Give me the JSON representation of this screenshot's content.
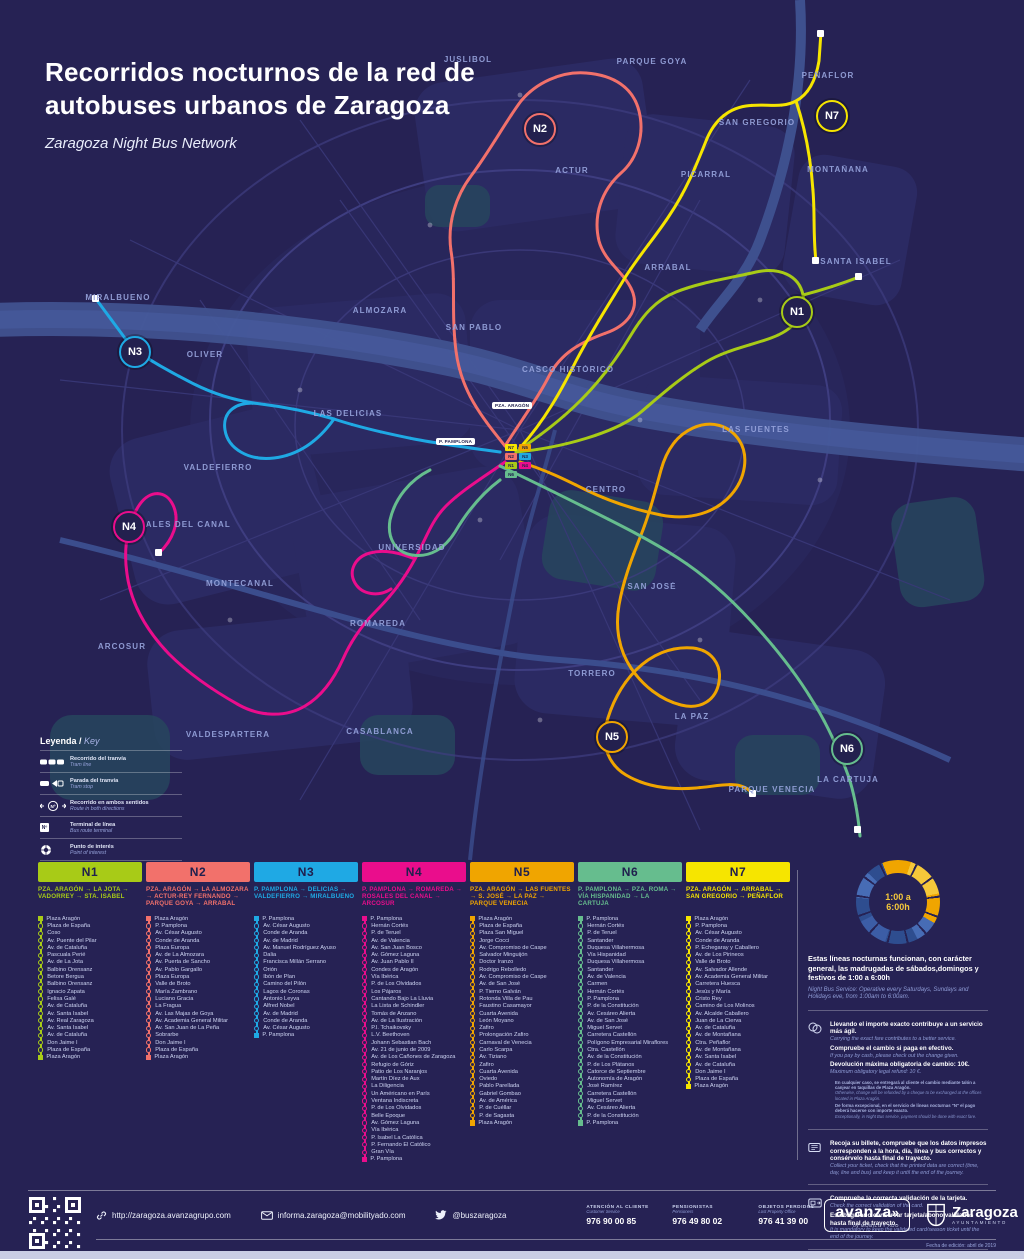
{
  "poster": {
    "title_line1": "Recorridos nocturnos de la red de",
    "title_line2": "autobuses urbanos de Zaragoza",
    "subtitle": "Zaragoza Night Bus Network"
  },
  "legend": {
    "title_es": "Leyenda /",
    "title_en": "Key",
    "nsymbol": "Nº",
    "items": [
      {
        "es": "Recorrido del tranvía",
        "en": "Tram line"
      },
      {
        "es": "Parada del tranvía",
        "en": "Tram stop"
      },
      {
        "es": "Recorrido en ambos sentidos",
        "en": "Route in both directions"
      },
      {
        "es": "Terminal de línea",
        "en": "Bus route terminal"
      },
      {
        "es": "Punto de interés",
        "en": "Point of interest"
      }
    ]
  },
  "map": {
    "areas": [
      {
        "label": "JUSLIBOL"
      },
      {
        "label": "PARQUE GOYA"
      },
      {
        "label": "PEÑAFLOR"
      },
      {
        "label": "SAN GREGORIO"
      },
      {
        "label": "MONTAÑANA"
      },
      {
        "label": "ACTUR"
      },
      {
        "label": "PICARRAL"
      },
      {
        "label": "ARRABAL"
      },
      {
        "label": "SANTA ISABEL"
      },
      {
        "label": "MIRALBUENO"
      },
      {
        "label": "ALMOZARA"
      },
      {
        "label": "SAN PABLO"
      },
      {
        "label": "OLIVER"
      },
      {
        "label": "CASCO HISTÓRICO"
      },
      {
        "label": "LAS DELICIAS"
      },
      {
        "label": "LAS FUENTES"
      },
      {
        "label": "VALDEFIERRO"
      },
      {
        "label": "CENTRO"
      },
      {
        "label": "ROSALES DEL CANAL"
      },
      {
        "label": "UNIVERSIDAD"
      },
      {
        "label": "MONTECANAL"
      },
      {
        "label": "SAN JOSÉ"
      },
      {
        "label": "ROMAREDA"
      },
      {
        "label": "ARCOSUR"
      },
      {
        "label": "TORRERO"
      },
      {
        "label": "LA PAZ"
      },
      {
        "label": "VALDESPARTERA"
      },
      {
        "label": "CASABLANCA"
      },
      {
        "label": "PARQUE VENECIA"
      },
      {
        "label": "LA CARTUJA"
      }
    ],
    "center_labels": [
      {
        "label": "PZA. ARAGÓN"
      },
      {
        "label": "P. PAMPLONA"
      }
    ]
  },
  "routes": [
    {
      "id": "N1",
      "color": "#a8cb17",
      "desc": "PZA. ARAGÓN → LA JOTA → VADORREY → STA. ISABEL",
      "stops": [
        "Plaza Aragón",
        "Plaza de España",
        "Coso",
        "Av. Puente del Pilar",
        "Av. de Cataluña",
        "Pascuala Perié",
        "Av. de La Jota",
        "Balbino Orensanz",
        "Betore Bergua",
        "Balbino Orensanz",
        "Ignacio Zapata",
        "Felisa Galé",
        "Av. de Cataluña",
        "Av. Santa Isabel",
        "Av. Real Zaragoza",
        "Av. Santa Isabel",
        "Av. de Cataluña",
        "Don Jaime I",
        "Plaza de España",
        "Plaza Aragón"
      ]
    },
    {
      "id": "N2",
      "color": "#f2716b",
      "desc": "PZA. ARAGÓN → LA ALMOZARA → ACTUR-REY FERNANDO → PARQUE GOYA → ARRABAL",
      "stops": [
        "Plaza Aragón",
        "P. Pamplona",
        "Av. César Augusto",
        "Conde de Aranda",
        "Plaza Europa",
        "Av. de La Almozara",
        "Av. Puerta de Sancho",
        "Av. Pablo Gargallo",
        "Plaza Europa",
        "Valle de Broto",
        "María Zambrano",
        "Luciano Gracia",
        "La Fragua",
        "Av. Las Majas de Goya",
        "Av. Academia General Militar",
        "Av. San Juan de La Peña",
        "Sobrarbe",
        "Don Jaime I",
        "Plaza de España",
        "Plaza Aragón"
      ]
    },
    {
      "id": "N3",
      "color": "#1fa9e4",
      "desc": "P. PAMPLONA → DELICIAS → VALDEFIERRO → MIRALBUENO",
      "stops": [
        "P. Pamplona",
        "Av. César Augusto",
        "Conde de Aranda",
        "Av. de Madrid",
        "Av. Manuel Rodríguez Ayuso",
        "Dalia",
        "Francisca Millán Serrano",
        "Orión",
        "Ibón de Plan",
        "Camino del Pilón",
        "Lagos de Coronas",
        "Antonio Leyva",
        "Alfred Nobel",
        "Av. de Madrid",
        "Conde de Aranda",
        "Av. César Augusto",
        "P. Pamplona"
      ]
    },
    {
      "id": "N4",
      "color": "#ea0d8c",
      "desc": "P. PAMPLONA → ROMAREDA → ROSALES DEL CANAL → ARCOSUR",
      "stops": [
        "P. Pamplona",
        "Hernán Cortés",
        "P. de Teruel",
        "Av. de Valencia",
        "Av. San Juan Bosco",
        "Av. Gómez Laguna",
        "Av. Juan Pablo II",
        "Condes de Aragón",
        "Vía Ibérica",
        "P. de Los Olvidados",
        "Los Pájaros",
        "Cantando Bajo La Lluvia",
        "La Lista de Schindler",
        "Tomás de Anzano",
        "Av. de La Ilustración",
        "P.I. Tchaikovsky",
        "L.V. Beethoven",
        "Johann Sebastian Bach",
        "Av. 21 de junio de 2009",
        "Av. de Los Cañones de Zaragoza",
        "Refugio de Góriz",
        "Patio de Los Naranjos",
        "Martín Díez de Aux",
        "La Diligencia",
        "Un Américano en París",
        "Ventana Indiscreta",
        "P. de Los Olvidados",
        "Belle Epoque",
        "Av. Gómez Laguna",
        "Vía Ibérica",
        "P. Isabel La Católica",
        "P. Fernando El Católico",
        "Gran Vía",
        "P. Pamplona"
      ]
    },
    {
      "id": "N5",
      "color": "#f0a500",
      "desc": "PZA. ARAGÓN → LAS FUENTES → S. JOSÉ → LA PAZ → PARQUE VENECIA",
      "stops": [
        "Plaza Aragón",
        "Plaza de España",
        "Plaza San Miguel",
        "Jorge Cocci",
        "Av. Compromiso de Caspe",
        "Salvador Minguijón",
        "Doctor Iranzo",
        "Rodrigo Rebolledo",
        "Av. Compromiso de Caspe",
        "Av. de San José",
        "P. Tierno Galván",
        "Rotonda Villa de Pau",
        "Faustino Casamayor",
        "Cuarta Avenida",
        "León Moyano",
        "Zafiro",
        "Prolongación Zafiro",
        "Carnaval de Venecia",
        "Carlo Scarpa",
        "Av. Tiziano",
        "Zafiro",
        "Cuarta Avenida",
        "Oviedo",
        "Pablo Parellada",
        "Gabriel Gombao",
        "Av. de América",
        "P. de Cuéllar",
        "P. de Sagasta",
        "Plaza Aragón"
      ]
    },
    {
      "id": "N6",
      "color": "#66bd8e",
      "desc": "P. PAMPLONA → PZA. ROMA → VÍA HISPANIDAD → LA CARTUJA",
      "stops": [
        "P. Pamplona",
        "Hernán Cortés",
        "P. de Teruel",
        "Santander",
        "Duquesa Villahermosa",
        "Vía Hispanidad",
        "Duquesa Villahermosa",
        "Santander",
        "Av. de Valencia",
        "Carmen",
        "Hernán Cortés",
        "P. Pamplona",
        "P. de la Constitución",
        "Av. Cesáreo Alierta",
        "Av. de San José",
        "Miguel Servet",
        "Carretera Castellón",
        "Polígono Empresarial Miraflores",
        "Ctra. Castellón",
        "Av. de la Constitución",
        "P. de Los Plátanos",
        "Catorce de Septiembre",
        "Autonomía de Aragón",
        "José Ramírez",
        "Carretera Castellón",
        "Miguel Servet",
        "Av. Cesáreo Alierta",
        "P. de la Constitución",
        "P. Pamplona"
      ]
    },
    {
      "id": "N7",
      "color": "#f6e500",
      "desc": "PZA. ARAGÓN → ARRABAL → SAN GREGORIO → PEÑAFLOR",
      "stops": [
        "Plaza Aragón",
        "P. Pamplona",
        "Av. César Augusto",
        "Conde de Aranda",
        "P. Echegaray y Caballero",
        "Av. de Los Pirineos",
        "Valle de Broto",
        "Av. Salvador Allende",
        "Av. Academia General Militar",
        "Carretera Huesca",
        "Jesús y María",
        "Cristo Rey",
        "Camino de Los Molinos",
        "Av. Alcalde Caballero",
        "Juan de La Cierva",
        "Av. de Cataluña",
        "Av. de Montañana",
        "Ctra. Peñaflor",
        "Av. de Montañana",
        "Av. Santa Isabel",
        "Av. de Cataluña",
        "Don Jaime I",
        "Plaza de España",
        "Plaza Aragón"
      ]
    }
  ],
  "info": {
    "clock_line1": "1:00 a",
    "clock_line2": "6:00h",
    "schedule_es": "Estas líneas nocturnas funcionan, con carácter general, las madrugadas de sábados,domingos y festivos de 1:00 a 6:00h",
    "schedule_en": "Night Bus Service: Operative every Saturdays, Sundays and Holidays eve, from 1:00am to 6:00am.",
    "items": [
      {
        "lines": [
          {
            "es": "Llevando el importe exacto contribuye a un servicio más ágil.",
            "en": "Carrying the exact fare contributes to a better service."
          },
          {
            "es": "Compruebe el cambio si paga en efectivo.",
            "en": "If you pay by cash, please check out the change given."
          },
          {
            "es": "Devolución máxima obligatoria de cambio: 10€.",
            "en": "Maximum obligatory legal refund: 10 €."
          }
        ],
        "fineprint": [
          {
            "es": "En cualquier caso, se entregará al cliente el cambio mediante talón a canjear en taquillas de Plaza Aragón.",
            "en": "Otherwise, change will be refunded by a cheque to be exchanged at the offices located in Plaza Aragón."
          },
          {
            "es": "De forma excepcional, en el servicio de líneas nocturnas \"N\" el pago deberá hacerse con importe exacto.",
            "en": "Exceptionally, in Night Bus service, payment should be done with exact fare."
          }
        ]
      },
      {
        "lines": [
          {
            "es": "Recoja su billete, compruebe que los datos impresos corresponden a la hora, día, línea y bus correctos y consérvelo hasta final de trayecto.",
            "en": "Collect your ticket, check that the printed data are correct (time, day, line and bus) and keep it until the end of the journey."
          }
        ]
      },
      {
        "lines": [
          {
            "es": "Compruebe la correcta validación de la tarjeta.",
            "en": "Check the correct validation of the card."
          },
          {
            "es": "Es obligatorio conservar tarjeta/abono validados hasta final de trayecto.",
            "en": "It is mandatory to keep the validated card/season ticket until the end of the journey."
          }
        ]
      },
      {
        "lines": [
          {
            "es": "El personal de la empresa o ayuntamiento pueden exigir la presentación del billete o tarjeta/abono validados.",
            "en": "The company staff or the local administration can demand the presentation of the validated ticket or card/season ticket."
          }
        ],
        "note_es": "Extracto Reglamento de viajeros (29 junio 2012)",
        "note_en": "Extract Travel Regulation. June, 29 2012"
      }
    ]
  },
  "footer": {
    "url": "http://zaragoza.avanzagrupo.com",
    "email": "informa.zaragoza@mobilityado.com",
    "twitter": "@buszaragoza",
    "phones": [
      {
        "label": "ATENCIÓN AL CLIENTE",
        "sub": "Customer Service",
        "number": "976 90 00 85"
      },
      {
        "label": "PENSIONISTAS",
        "sub": "Pensioners",
        "number": "976 49 80 02"
      },
      {
        "label": "OBJETOS PERDIDOS",
        "sub": "Lost Property Office",
        "number": "976 41 39 00"
      }
    ],
    "avanza": "avanza",
    "avanza_chevrons": "»",
    "avanza_sub": "by MOBILITY ADO",
    "zaragoza": "Zaragoza",
    "zaragoza_sub": "AYUNTAMIENTO",
    "edition": "Fecha de edición: abril de 2019"
  }
}
